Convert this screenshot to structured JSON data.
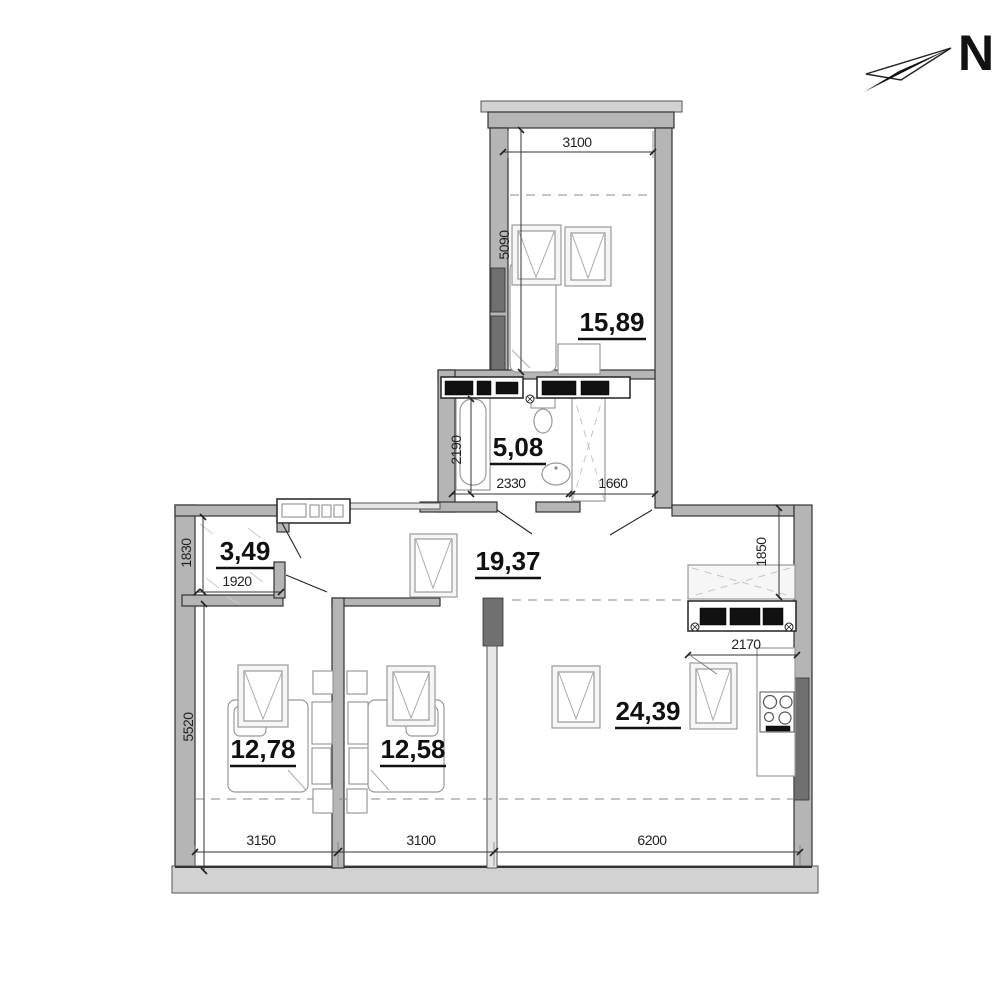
{
  "north": {
    "label": "N"
  },
  "rooms": {
    "top_bedroom": {
      "area": "15,89"
    },
    "bathroom": {
      "area": "5,08"
    },
    "balcony": {
      "area": "3,49"
    },
    "hallway": {
      "area": "19,37"
    },
    "bedroom_left": {
      "area": "12,78"
    },
    "bedroom_right": {
      "area": "12,58"
    },
    "living_kitchen": {
      "area": "24,39"
    }
  },
  "dimensions": {
    "top_bedroom_width": "3100",
    "top_bedroom_depth": "5090",
    "bathroom_depth": "2190",
    "bathroom_width": "2330",
    "entry_corridor_width": "1660",
    "balcony_depth": "1830",
    "balcony_width": "1920",
    "kitchen_depth": "1850",
    "kitchen_counter_width": "2170",
    "body_depth": "5520",
    "bottom_left_width": "3150",
    "bottom_middle_width": "3100",
    "bottom_right_width": "6200"
  },
  "colors": {
    "wall_fill": "#b5b5b5",
    "wall_outline": "#333333",
    "dark_marker": "#707070",
    "fixture_black": "#111111",
    "dim_text": "#222222"
  }
}
